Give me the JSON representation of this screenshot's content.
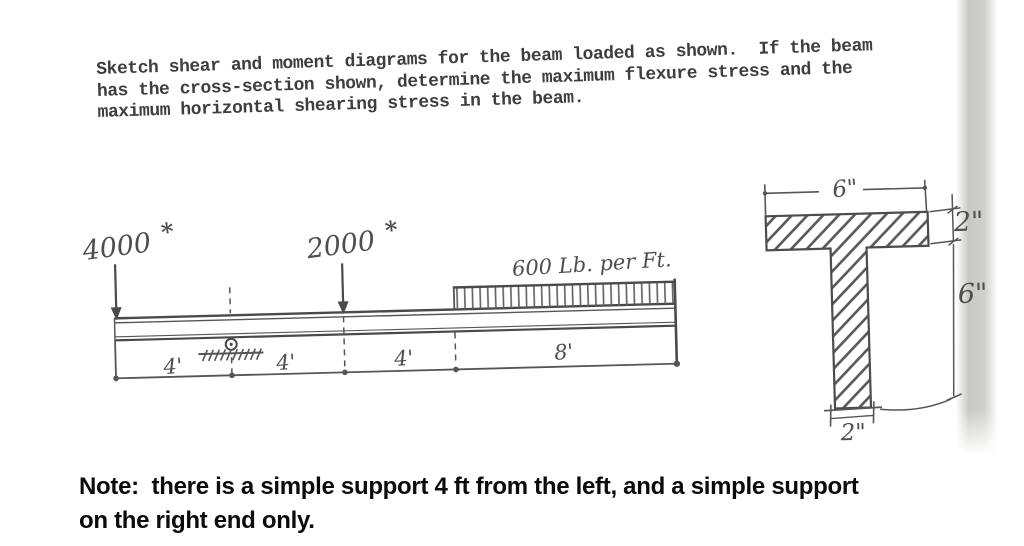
{
  "problem": {
    "lines": [
      "Sketch shear and moment diagrams for the beam loaded as shown.  If the beam",
      "has the cross-section shown, determine the maximum flexure stress and the",
      "maximum horizontal shearing stress in the beam."
    ]
  },
  "beam": {
    "loads": [
      {
        "value": "4000",
        "unit": "*"
      },
      {
        "value": "2000",
        "unit": "*"
      }
    ],
    "distributed_load": "600 Lb. per Ft.",
    "span_labels": [
      "4'",
      "4'",
      "4'",
      "8'"
    ]
  },
  "cross_section": {
    "flange_width": "6\"",
    "flange_thickness": "2\"",
    "web_height": "6\"",
    "web_width": "2\""
  },
  "note": {
    "lines": [
      "Note:  there is a simple support 4 ft from the left, and a simple support",
      "on the right end only."
    ]
  },
  "colors": {
    "typed_ink": "#3e3e3e",
    "pencil": "#555555",
    "note_ink": "#0b0b0b",
    "page_shadow": "#c3c3bf"
  }
}
